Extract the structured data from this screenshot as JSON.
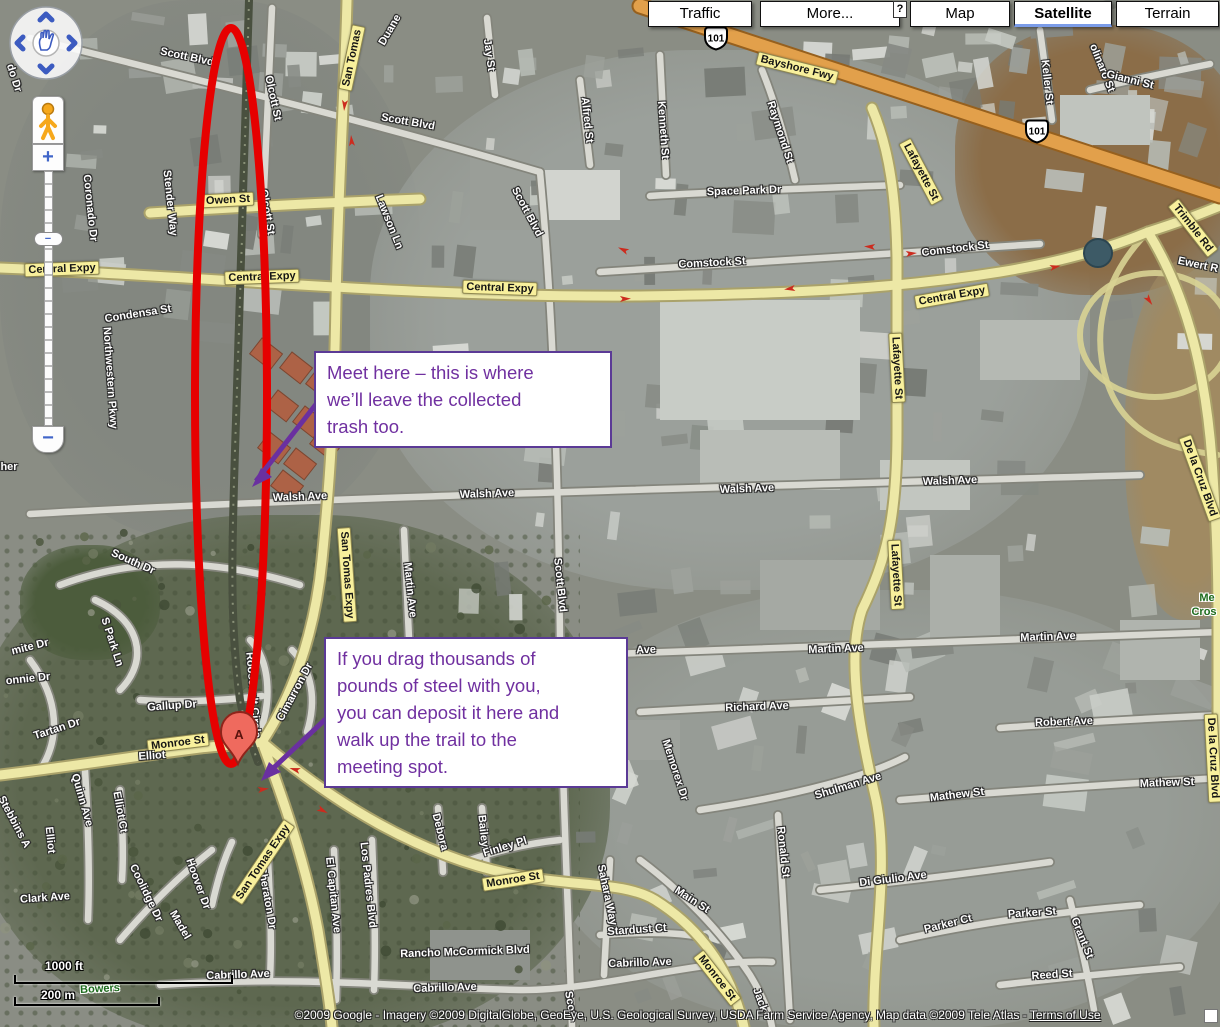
{
  "ui": {
    "buttons": [
      "Traffic",
      "More...",
      "Map",
      "Satellite",
      "Terrain"
    ],
    "selected_view": "Satellite",
    "help_badge": "?",
    "scale": {
      "ft": "1000 ft",
      "m": "200 m"
    },
    "copyright": "©2009 Google - Imagery ©2009 DigitalGlobe, GeoEye, U.S. Geological Survey, USDA Farm Service Agency, Map data ©2009 Tele Atlas - ",
    "terms_link": "Terms of Use",
    "zoom_in_label": "+",
    "zoom_out_label": "−",
    "zoom_handle_label": "−"
  },
  "annotations": {
    "callout1": "Meet here – this is where\nwe’ll leave the collected\ntrash too.",
    "callout2": "If you drag thousands of\npounds of steel with you,\nyou can deposit it here and\nwalk up the trail to the\nmeeting spot.",
    "marker_label": "A",
    "colors": {
      "purple": "#7030a0",
      "red": "#e60000"
    }
  },
  "map_labels": [
    {
      "t": "Scott Blvd",
      "x": 187,
      "y": 57,
      "r": 12
    },
    {
      "t": "Olcott St",
      "x": 273,
      "y": 98,
      "r": 78
    },
    {
      "t": "Scott Blvd",
      "x": 408,
      "y": 122,
      "r": 10
    },
    {
      "t": "Olcott St",
      "x": 267,
      "y": 212,
      "r": 80
    },
    {
      "t": "San Tomas",
      "x": 352,
      "y": 58,
      "r": -78,
      "s": "y"
    },
    {
      "t": "Duane",
      "x": 390,
      "y": 30,
      "r": -60
    },
    {
      "t": "Jay St",
      "x": 489,
      "y": 55,
      "r": 82
    },
    {
      "t": "Alfred St",
      "x": 587,
      "y": 120,
      "r": 84
    },
    {
      "t": "Kenneth St",
      "x": 663,
      "y": 130,
      "r": 86
    },
    {
      "t": "Raymond St",
      "x": 780,
      "y": 132,
      "r": 72
    },
    {
      "t": "Scott Blvd",
      "x": 527,
      "y": 212,
      "r": 62
    },
    {
      "t": "101",
      "x": 716,
      "y": 40,
      "s": "s"
    },
    {
      "t": "Bayshore Fwy",
      "x": 797,
      "y": 68,
      "r": 14,
      "s": "y"
    },
    {
      "t": "Keller St",
      "x": 1047,
      "y": 82,
      "r": 84
    },
    {
      "t": "olinaro St",
      "x": 1102,
      "y": 68,
      "r": 68
    },
    {
      "t": "Gianni St",
      "x": 1130,
      "y": 80,
      "r": 14
    },
    {
      "t": "101",
      "x": 1037,
      "y": 133,
      "s": "s"
    },
    {
      "t": "Trimble Rd",
      "x": 1193,
      "y": 228,
      "r": 52,
      "s": "y"
    },
    {
      "t": "Ewert R",
      "x": 1198,
      "y": 265,
      "r": 12
    },
    {
      "t": "Lafayette St",
      "x": 921,
      "y": 172,
      "r": 62,
      "s": "y"
    },
    {
      "t": "Space Park Dr",
      "x": 744,
      "y": 191,
      "r": -2
    },
    {
      "t": "Owen St",
      "x": 228,
      "y": 200,
      "r": -3,
      "s": "y"
    },
    {
      "t": "Lawson Ln",
      "x": 389,
      "y": 222,
      "r": 68
    },
    {
      "t": "Coronado Dr",
      "x": 90,
      "y": 208,
      "r": 84
    },
    {
      "t": "Stender Way",
      "x": 170,
      "y": 203,
      "r": 84
    },
    {
      "t": "do Dr",
      "x": 14,
      "y": 78,
      "r": 72
    },
    {
      "t": "Central Expy",
      "x": 62,
      "y": 269,
      "r": -2,
      "s": "y"
    },
    {
      "t": "Central Expy",
      "x": 262,
      "y": 277,
      "r": -2,
      "s": "y"
    },
    {
      "t": "Central Expy",
      "x": 500,
      "y": 288,
      "r": 2,
      "s": "y"
    },
    {
      "t": "Comstock St",
      "x": 712,
      "y": 263,
      "r": -3
    },
    {
      "t": "Comstock St",
      "x": 955,
      "y": 249,
      "r": -7
    },
    {
      "t": "Central Expy",
      "x": 952,
      "y": 296,
      "r": -10,
      "s": "y"
    },
    {
      "t": "Condensa St",
      "x": 138,
      "y": 314,
      "r": -9
    },
    {
      "t": "Northwestern Pkwy",
      "x": 110,
      "y": 378,
      "r": 86
    },
    {
      "t": "Lafayette St",
      "x": 897,
      "y": 368,
      "r": 87,
      "s": "y"
    },
    {
      "t": "De la Cruz Blvd",
      "x": 1200,
      "y": 478,
      "r": 70,
      "s": "y"
    },
    {
      "t": "Walsh Ave",
      "x": 300,
      "y": 497,
      "r": -2
    },
    {
      "t": "Walsh Ave",
      "x": 487,
      "y": 494,
      "r": -2
    },
    {
      "t": "Walsh Ave",
      "x": 747,
      "y": 489,
      "r": -2
    },
    {
      "t": "Walsh Ave",
      "x": 950,
      "y": 481,
      "r": -2
    },
    {
      "t": "her",
      "x": 9,
      "y": 467,
      "r": 0
    },
    {
      "t": "San Tomas Expy",
      "x": 347,
      "y": 575,
      "r": 86,
      "s": "y"
    },
    {
      "t": "Martin Ave",
      "x": 410,
      "y": 590,
      "r": 84
    },
    {
      "t": "Scott Blvd",
      "x": 560,
      "y": 585,
      "r": 84
    },
    {
      "t": "Lafayette St",
      "x": 896,
      "y": 575,
      "r": 87,
      "s": "y"
    },
    {
      "t": "Me",
      "x": 1207,
      "y": 598,
      "r": 0,
      "s": "g"
    },
    {
      "t": "Cros",
      "x": 1204,
      "y": 612,
      "r": 0,
      "s": "g"
    },
    {
      "t": "mite Dr",
      "x": 30,
      "y": 647,
      "r": -14
    },
    {
      "t": "South Dr",
      "x": 133,
      "y": 562,
      "r": 24
    },
    {
      "t": "S Park Ln",
      "x": 112,
      "y": 642,
      "r": 72
    },
    {
      "t": "onnie Dr",
      "x": 28,
      "y": 679,
      "r": -6
    },
    {
      "t": "Gallup Dr",
      "x": 172,
      "y": 706,
      "r": -4
    },
    {
      "t": "Tartan Dr",
      "x": 57,
      "y": 729,
      "r": -18
    },
    {
      "t": "Monroe St",
      "x": 178,
      "y": 743,
      "r": -7,
      "s": "y"
    },
    {
      "t": "Elliot",
      "x": 152,
      "y": 756,
      "r": -4
    },
    {
      "t": "Roosevelt Circle",
      "x": 253,
      "y": 695,
      "r": 85
    },
    {
      "t": "Cimarron Dr",
      "x": 295,
      "y": 692,
      "r": -62
    },
    {
      "t": "Quinn Ave",
      "x": 82,
      "y": 800,
      "r": 74
    },
    {
      "t": "Elliot Ct",
      "x": 120,
      "y": 812,
      "r": 80
    },
    {
      "t": "Elliot",
      "x": 50,
      "y": 840,
      "r": 84
    },
    {
      "t": "Stebbins A",
      "x": 14,
      "y": 822,
      "r": 62
    },
    {
      "t": "Ave",
      "x": 646,
      "y": 650,
      "r": -2
    },
    {
      "t": "Martin Ave",
      "x": 836,
      "y": 649,
      "r": -2
    },
    {
      "t": "Martin Ave",
      "x": 1048,
      "y": 637,
      "r": -2
    },
    {
      "t": "Richard Ave",
      "x": 757,
      "y": 707,
      "r": -2
    },
    {
      "t": "Memorex Dr",
      "x": 675,
      "y": 770,
      "r": 72
    },
    {
      "t": "Shulman Ave",
      "x": 848,
      "y": 786,
      "r": -17
    },
    {
      "t": "Mathew St",
      "x": 957,
      "y": 795,
      "r": -7
    },
    {
      "t": "Mathew St",
      "x": 1167,
      "y": 783,
      "r": -2
    },
    {
      "t": "Robert Ave",
      "x": 1064,
      "y": 722,
      "r": -2
    },
    {
      "t": "Ronald St",
      "x": 783,
      "y": 852,
      "r": 84
    },
    {
      "t": "De la Cruz Blvd",
      "x": 1213,
      "y": 758,
      "r": 87,
      "s": "y"
    },
    {
      "t": "Di Giulio Ave",
      "x": 893,
      "y": 879,
      "r": -7
    },
    {
      "t": "Parker Ct",
      "x": 948,
      "y": 924,
      "r": -14
    },
    {
      "t": "Parker St",
      "x": 1032,
      "y": 913,
      "r": -4
    },
    {
      "t": "Grant St",
      "x": 1082,
      "y": 938,
      "r": 68
    },
    {
      "t": "Reed St",
      "x": 1052,
      "y": 975,
      "r": -4
    },
    {
      "t": "Clark Ave",
      "x": 45,
      "y": 898,
      "r": -4
    },
    {
      "t": "Coolidge Dr",
      "x": 146,
      "y": 893,
      "r": 64
    },
    {
      "t": "Hoover Dr",
      "x": 198,
      "y": 884,
      "r": 70
    },
    {
      "t": "Madel",
      "x": 180,
      "y": 925,
      "r": 60
    },
    {
      "t": "Sheraton Dr",
      "x": 267,
      "y": 898,
      "r": 80
    },
    {
      "t": "El Capitan Ave",
      "x": 333,
      "y": 895,
      "r": 84
    },
    {
      "t": "Los Padres Blvd",
      "x": 368,
      "y": 885,
      "r": 84
    },
    {
      "t": "Debora",
      "x": 440,
      "y": 832,
      "r": 76
    },
    {
      "t": "Bailey",
      "x": 483,
      "y": 831,
      "r": 84
    },
    {
      "t": "Finley Pl",
      "x": 505,
      "y": 847,
      "r": -17
    },
    {
      "t": "Monroe St",
      "x": 513,
      "y": 880,
      "r": -9,
      "s": "y"
    },
    {
      "t": "San Tomas Expy",
      "x": 263,
      "y": 862,
      "r": -56,
      "s": "y"
    },
    {
      "t": "Rancho McCormick Blvd",
      "x": 465,
      "y": 952,
      "r": -2
    },
    {
      "t": "Cabrillo Ave",
      "x": 238,
      "y": 975,
      "r": -2
    },
    {
      "t": "Cabrillo Ave",
      "x": 445,
      "y": 988,
      "r": -2
    },
    {
      "t": "Cabrillo Ave",
      "x": 640,
      "y": 963,
      "r": -2
    },
    {
      "t": "Sahara Way",
      "x": 607,
      "y": 895,
      "r": 78
    },
    {
      "t": "Main St",
      "x": 692,
      "y": 900,
      "r": 33
    },
    {
      "t": "Stardust Ct",
      "x": 637,
      "y": 930,
      "r": -4
    },
    {
      "t": "Monroe St",
      "x": 717,
      "y": 978,
      "r": 52,
      "s": "y"
    },
    {
      "t": "Jack",
      "x": 760,
      "y": 1000,
      "r": 70
    },
    {
      "t": "Scot",
      "x": 570,
      "y": 1003,
      "r": 80
    },
    {
      "t": "Bowers",
      "x": 100,
      "y": 989,
      "r": -3,
      "s": "g"
    }
  ]
}
